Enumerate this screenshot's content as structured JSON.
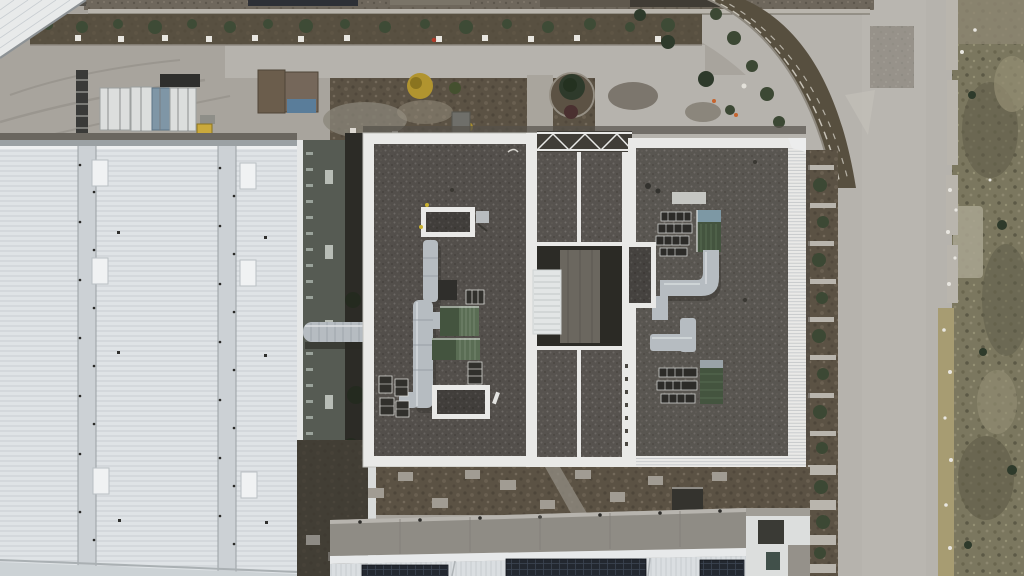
{
  "meta": {
    "scene": "aerial-drone-view-industrial-facility",
    "width": 1024,
    "height": 576
  },
  "palette": {
    "concrete": "#a8a49d",
    "road": "#b6b3ad",
    "road_edge": "#918d86",
    "warehouse_roof": "#dfe3e6",
    "seam": "#ccd1d5",
    "eave_gray": "#9ba1a4",
    "parapet_white": "#e9e9e7",
    "gravel": "#57534f",
    "annex_wall": "#565b53",
    "alley_dark": "#2c2b26",
    "soil": "#584f42",
    "garden_soil": "#574f3f",
    "dirt": "#675e50",
    "rubble": "#6e675c",
    "grass": "#7b775f",
    "tree_green": "#3e4b36",
    "conifer": "#2e3a2b",
    "shrub": "#3c4834",
    "yellow_tree": "#b1942f",
    "maroon_bush": "#4a3030",
    "island_soil": "#5c5244",
    "green_unit": "#44543f",
    "green_unit_light": "#5a6d54",
    "unit_cap_blue": "#7d98a4",
    "duct_silver": "#b6bcc1",
    "duct_edge": "#8e959b",
    "skylight_white": "#f0f2f3",
    "louver": "#e2e5e5",
    "truss_dark": "#403d37",
    "courtyard_floor": "#6b675f",
    "walkway": "#8f8c85",
    "walkway_edge": "#b7b4ae",
    "solar_dark": "#232830",
    "container_white": "#dcdedd",
    "container_blue": "#7f96a6",
    "container_brown": "#6b5d4c",
    "tarp_blue": "#5a7d9a",
    "cabinet_yellow": "#caa93c",
    "pad_light": "#a19c93",
    "wall_light": "#b9b5ad",
    "debris_white": "#e8e6e0",
    "curb_tan": "#a79c72",
    "dark_shed": "#34332e",
    "structure_white": "#dcdedd",
    "shadow_dark": "#55514a"
  },
  "scene": {
    "regions": [
      "storage-yard",
      "top-landscaped-strip",
      "perimeter-road",
      "ornamental-garden-curve",
      "white-warehouse-roof",
      "annex-wall",
      "service-alley",
      "gravel-roof-main-building",
      "roof-courtyard",
      "right-landscape-strip",
      "vertical-access-road",
      "dry-grass-lot",
      "rear-dirt-strip",
      "rear-walkway",
      "solar-roof-building"
    ],
    "objects": {
      "warehouse": {
        "label": "white-corrugated-warehouse-roof",
        "skylights": 6,
        "panel_seams": 2
      },
      "main_building": {
        "label": "gravel-flat-roof-production-building",
        "wings": 2,
        "green_air_handlers": 4,
        "roof_skylights": 3,
        "duct_runs": 3
      },
      "bottom_building": {
        "label": "lower-building-with-solar-panels",
        "solar_arrays": 3
      },
      "storage_yard": {
        "containers": 5,
        "yellow_cabinet": 1,
        "ladder_tower": 1
      },
      "roundabout_island": {
        "trees": 1,
        "red_bush": 1
      },
      "duct_bridge": {
        "label": "silver-duct-crossing-alley"
      }
    }
  }
}
